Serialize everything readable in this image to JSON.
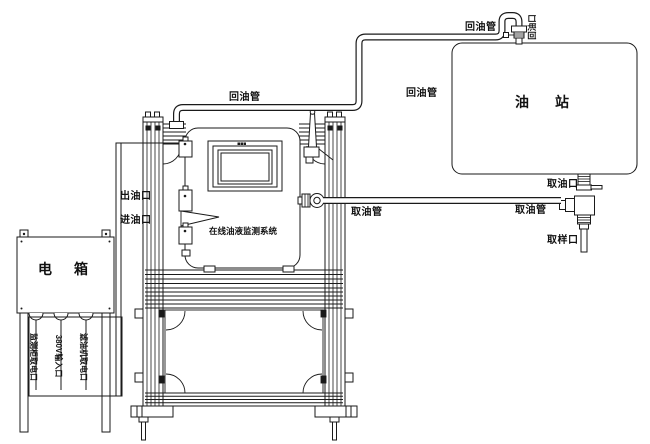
{
  "colors": {
    "line": "#1a1a1a",
    "background": "#ffffff"
  },
  "pipes": {
    "return_pipe_label_1": "回油管",
    "return_pipe_label_2": "回油管",
    "return_pipe_label_3": "回油管",
    "intake_pipe_label_1": "取油管",
    "intake_pipe_label_2": "取油管"
  },
  "oil_station": {
    "title": "油站",
    "return_port_label": "回油口",
    "intake_port_label": "取油口",
    "sampling_port_label": "取样口"
  },
  "monitor_cabinet": {
    "system_name": "在线油液监测系统",
    "outlet_port_label": "出油口",
    "inlet_port_label": "进油口"
  },
  "electric_box": {
    "title": "电箱",
    "cable_labels": [
      "监测柜取电口",
      "380V输入口",
      "滤油机取电口"
    ]
  }
}
